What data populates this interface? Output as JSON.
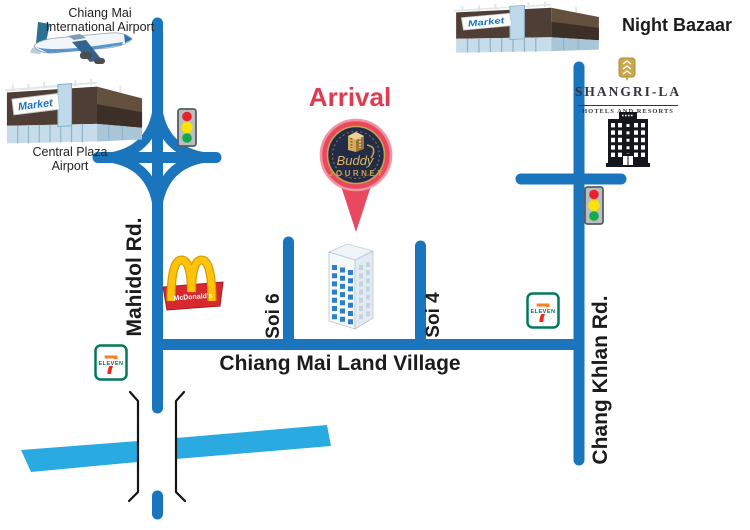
{
  "arrival": {
    "title": "Arrival",
    "brand_script": "Buddy",
    "brand_caps": "JOURNEY"
  },
  "roads": {
    "mahidol": "Mahidol Rd.",
    "chang_khlan": "Chang Khlan Rd.",
    "soi6": "Soi 6",
    "soi4": "Soi 4",
    "main": "Chiang Mai Land Village"
  },
  "landmarks": {
    "airport": {
      "label_line1": "Chiang Mai",
      "label_line2": "International Airport"
    },
    "central_plaza": {
      "label_line1": "Central Plaza",
      "label_line2": "Airport",
      "sign": "Market"
    },
    "night_bazaar": {
      "label": "Night Bazaar",
      "sign": "Market"
    },
    "shangrila": {
      "name": "SHANGRI-LA",
      "subtitle": "HOTELS AND RESORTS"
    },
    "mcdonalds": {
      "label": "McDonald's"
    },
    "seven_eleven": {
      "digit": "7",
      "label": "ELEVEN"
    }
  },
  "colors": {
    "road_blue": "#1b75bc",
    "superhighway_cyan": "#29abe2",
    "arrival_red": "#e23a50",
    "pin_red": "#e8495e",
    "pin_navy": "#232c47",
    "gold": "#c9a050",
    "mcdonalds_yellow": "#ffc10e",
    "mcdonalds_red": "#d7282f",
    "seven_green": "#00795c",
    "seven_orange": "#f58220",
    "seven_red": "#ee2a24",
    "traffic_red": "#e8212d",
    "traffic_yellow": "#ffe300",
    "traffic_green": "#17a84b"
  },
  "icons": {
    "airplane-icon": "jet airliner side view",
    "market-building-icon": "3D market hall",
    "traffic-light-icon": "red-yellow-green signal",
    "golden-arches-icon": "McDonald's arches on red sign",
    "seven-eleven-icon": "7-Eleven store badge",
    "tower-building-icon": "destination tower with blue windows",
    "hotel-building-icon": "black hotel facade",
    "shangrila-emblem-icon": "gold hotel crest",
    "arrival-pin-icon": "red map pin with Buddy Journey logo",
    "interchange-icon": "curved motorway interchange",
    "tunnel-brackets-icon": "underpass portal marks"
  }
}
